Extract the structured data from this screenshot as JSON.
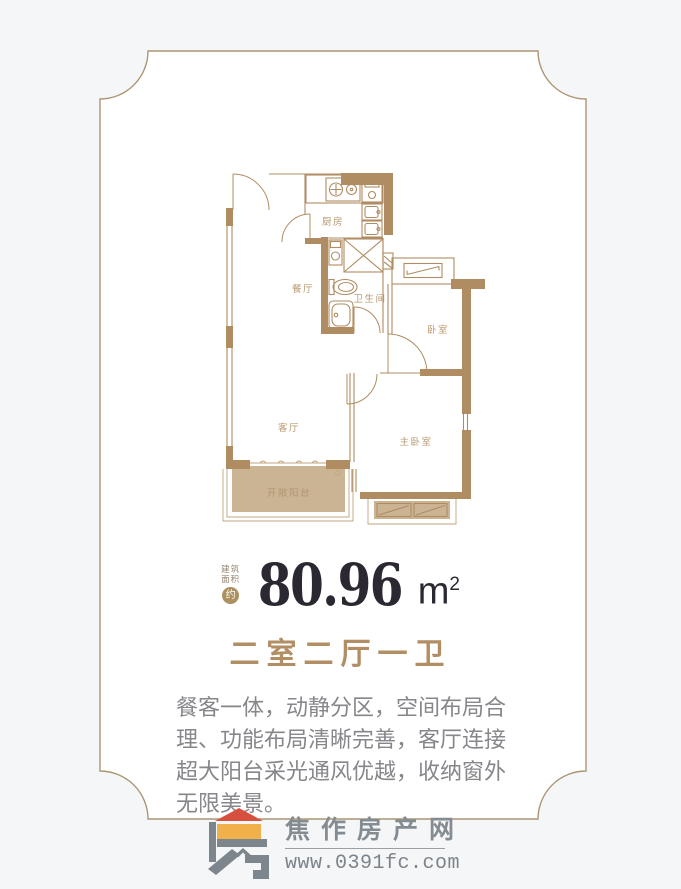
{
  "page": {
    "background": "#f5f6f8"
  },
  "card": {
    "border_color": "#aa9673",
    "fill": "#ffffff"
  },
  "floorplan": {
    "wall_color": "#b08c62",
    "balcony_fill": "#cbb493",
    "label_color": "#b79a72",
    "rooms": [
      {
        "id": "kitchen",
        "label": "厨房"
      },
      {
        "id": "dining",
        "label": "餐厅"
      },
      {
        "id": "bathroom",
        "label": "卫生间"
      },
      {
        "id": "bedroom",
        "label": "卧室"
      },
      {
        "id": "living",
        "label": "客厅"
      },
      {
        "id": "master-bedroom",
        "label": "主卧室"
      },
      {
        "id": "balcony",
        "label": "开敞阳台"
      }
    ]
  },
  "area": {
    "prefix_line1": "建筑",
    "prefix_line2": "面积",
    "approx_badge": "约",
    "value": "80.96",
    "unit": "m",
    "unit_exponent": "2"
  },
  "title": {
    "text": "二室二厅一卫"
  },
  "description": {
    "lines": [
      "餐客一体，动静分区，空间布局合",
      "理、功能布局清晰完善，客厅连接",
      "超大阳台采光通风优越，收纳窗外",
      "无限美景。"
    ]
  },
  "footer": {
    "site_name": "焦作房产网",
    "site_url": "www.0391fc.com",
    "logo_red": "#d7503f",
    "logo_gold": "#f0b14a",
    "logo_gray": "#7e868d"
  }
}
